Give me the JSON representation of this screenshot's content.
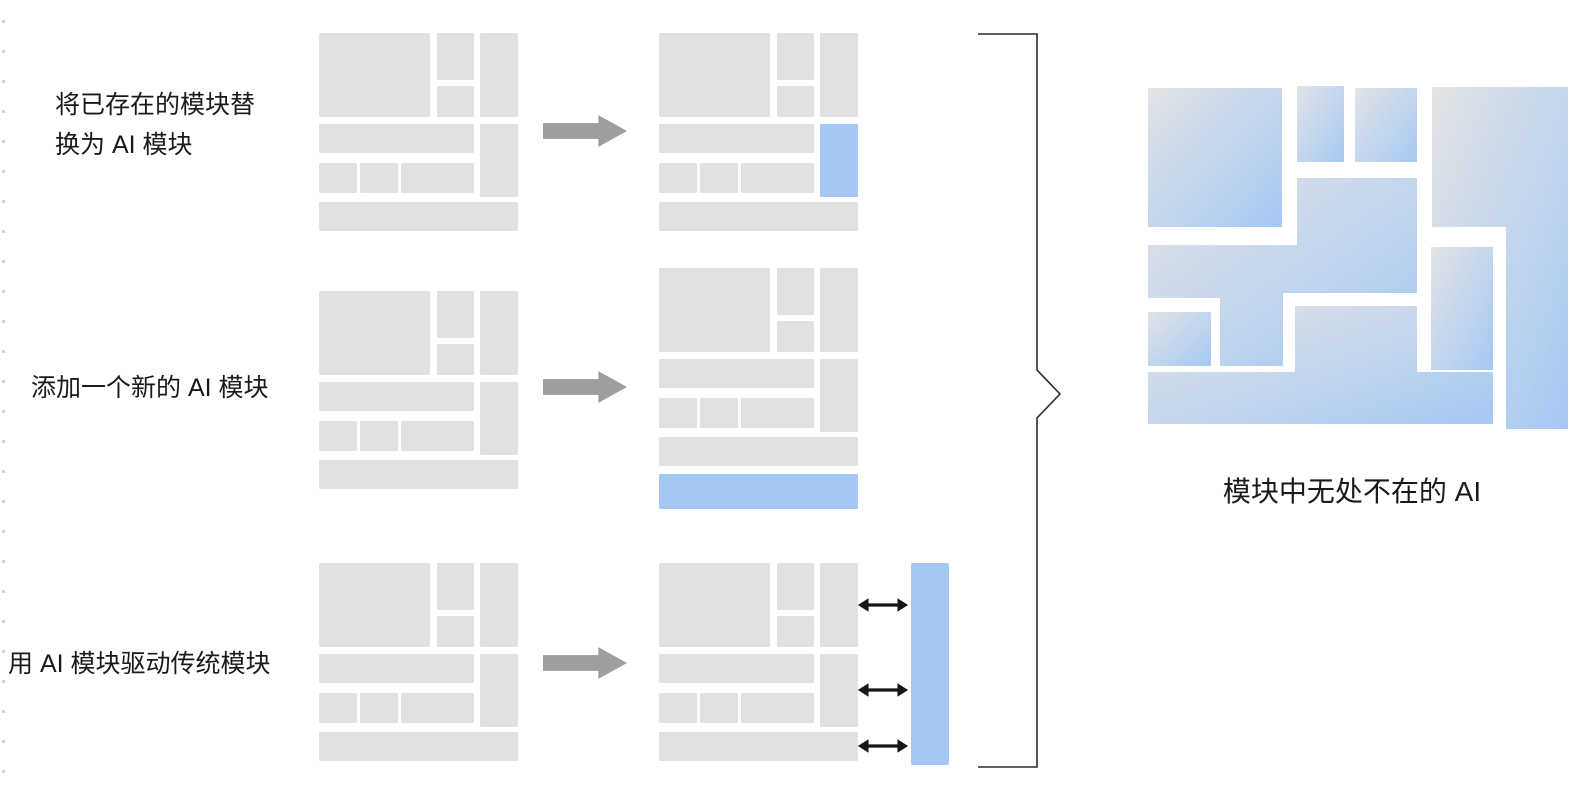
{
  "labels": {
    "rows": [
      {
        "lines": [
          "将已存在的模块替",
          "换为 AI 模块"
        ]
      },
      {
        "lines": [
          "添加一个新的 AI 模块"
        ]
      },
      {
        "lines": [
          "用 AI 模块驱动传统模块"
        ]
      }
    ],
    "result": "模块中无处不在的 AI"
  },
  "icons": {
    "transform_arrow": "right-block-arrow",
    "link_arrow": "double-headed-arrow",
    "brace": "right-angular-brace"
  },
  "colors": {
    "block_gray": "#e1e1e1",
    "ai_blue": "#a3c8f4",
    "arrow_gray": "#9e9e9e",
    "link_arrow_black": "#161616",
    "brace_dark": "#2b2b2b",
    "text": "#1a1a1a",
    "dash_gray": "#cdcdcd",
    "background": "#ffffff",
    "gradient_gray": "#e3e4e6",
    "gradient_blue": "#a5c8f3"
  }
}
